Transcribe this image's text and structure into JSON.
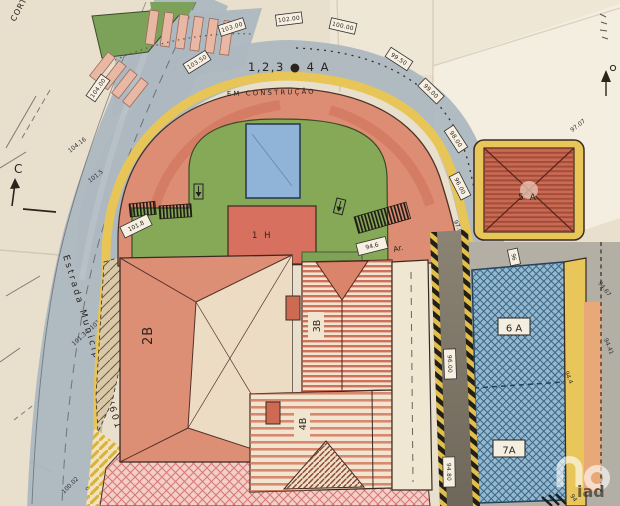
{
  "annotations": {
    "corner_note": "CORTE",
    "section_marker": "C",
    "road_name": "Estrada Municipal 600/601",
    "lots_label": "1,2,3 ● 4 A",
    "status_label": "EM CONSTRUÇÃO",
    "ar_note": "Ar.",
    "watermark": "iad"
  },
  "buildings": {
    "b1h": "1 H",
    "b2b": "2B",
    "b3b": "3B",
    "b4b": "4B",
    "b5a": "5 A",
    "b6a": "6 A",
    "b7a": "7A"
  },
  "elevations": {
    "left_road": [
      "104.16",
      "101.5",
      "101.6",
      "101.34",
      "100.02",
      "99"
    ],
    "curve_boxes": [
      "104.00",
      "103.50",
      "103.00",
      "102.00",
      "100.00",
      "99.50",
      "99.00",
      "98.00",
      "96.00"
    ],
    "curve_note": "97.02",
    "plateau_note": "97.07",
    "stair_box_left": "101.8",
    "stair_box_right": "94.6",
    "road_boxes": [
      "96.00",
      "94.80"
    ],
    "below_5a_box": "96",
    "right_edge": [
      "94.67",
      "94.41",
      "94.4",
      "94"
    ]
  },
  "colors": {
    "paper": "#e9dfcd",
    "road_blue": "#adb7c0",
    "curb_yellow": "#e7c557",
    "arch_red": "#dd8d73",
    "lawn_green": "#86a957",
    "pool_blue": "#8fb4d8",
    "roof_stripe_red": "#c4543f",
    "parcel_blue": "#93b9d0",
    "access_road_gray": "#7e7767",
    "strip_orange": "#e8a878",
    "courtyard_pink": "#f3cfc6"
  }
}
